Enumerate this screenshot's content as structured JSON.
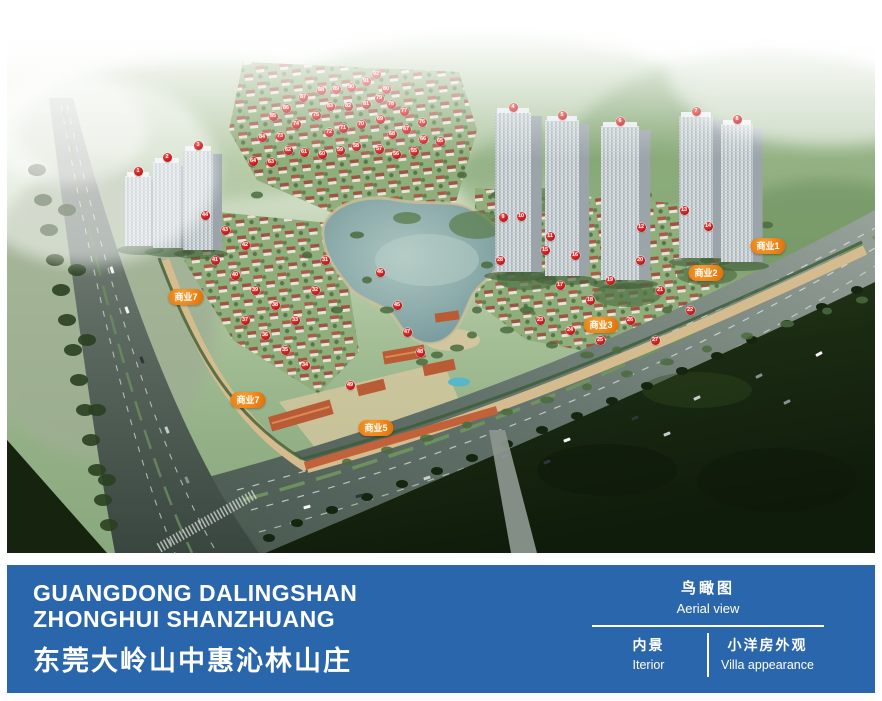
{
  "footer": {
    "bg": "#2a66ac",
    "title_en_line1": "GUANGDONG DALINGSHAN",
    "title_en_line2": "ZHONGHUI SHANZHUANG",
    "title_zh": "东莞大岭山中惠沁林山庄",
    "views": {
      "current": {
        "zh": "鸟瞰图",
        "en": "Aerial view"
      },
      "others": [
        {
          "zh": "内景",
          "en": "Iterior"
        },
        {
          "zh": "小洋房外观",
          "en": "Villa appearance"
        }
      ]
    }
  },
  "site_plan": {
    "marker_color": "#cf1d1d",
    "biz_label_color": "#ec8418",
    "biz_labels": [
      {
        "text": "商业1",
        "x": 761,
        "y": 236
      },
      {
        "text": "商业2",
        "x": 699,
        "y": 263
      },
      {
        "text": "商业3",
        "x": 594,
        "y": 315
      },
      {
        "text": "商业5",
        "x": 369,
        "y": 418
      },
      {
        "text": "商业7",
        "x": 179,
        "y": 287
      },
      {
        "text": "商业7",
        "x": 241,
        "y": 390
      }
    ],
    "markers": [
      {
        "n": 1,
        "x": 131,
        "y": 161
      },
      {
        "n": 2,
        "x": 160,
        "y": 147
      },
      {
        "n": 3,
        "x": 191,
        "y": 135
      },
      {
        "n": 4,
        "x": 506,
        "y": 97
      },
      {
        "n": 5,
        "x": 555,
        "y": 105
      },
      {
        "n": 6,
        "x": 613,
        "y": 111
      },
      {
        "n": 7,
        "x": 689,
        "y": 101
      },
      {
        "n": 8,
        "x": 730,
        "y": 109
      },
      {
        "n": 9,
        "x": 496,
        "y": 207
      },
      {
        "n": 10,
        "x": 514,
        "y": 206
      },
      {
        "n": 11,
        "x": 543,
        "y": 226
      },
      {
        "n": 12,
        "x": 634,
        "y": 217
      },
      {
        "n": 13,
        "x": 677,
        "y": 200
      },
      {
        "n": 14,
        "x": 701,
        "y": 216
      },
      {
        "n": 15,
        "x": 538,
        "y": 240
      },
      {
        "n": 16,
        "x": 568,
        "y": 245
      },
      {
        "n": 17,
        "x": 553,
        "y": 275
      },
      {
        "n": 18,
        "x": 583,
        "y": 290
      },
      {
        "n": 19,
        "x": 603,
        "y": 270
      },
      {
        "n": 20,
        "x": 633,
        "y": 250
      },
      {
        "n": 21,
        "x": 653,
        "y": 280
      },
      {
        "n": 22,
        "x": 683,
        "y": 300
      },
      {
        "n": 23,
        "x": 533,
        "y": 310
      },
      {
        "n": 24,
        "x": 563,
        "y": 320
      },
      {
        "n": 25,
        "x": 593,
        "y": 330
      },
      {
        "n": 26,
        "x": 623,
        "y": 310
      },
      {
        "n": 27,
        "x": 648,
        "y": 330
      },
      {
        "n": 28,
        "x": 493,
        "y": 250
      },
      {
        "n": 31,
        "x": 318,
        "y": 250
      },
      {
        "n": 32,
        "x": 308,
        "y": 280
      },
      {
        "n": 33,
        "x": 288,
        "y": 310
      },
      {
        "n": 34,
        "x": 298,
        "y": 355
      },
      {
        "n": 35,
        "x": 278,
        "y": 340
      },
      {
        "n": 36,
        "x": 258,
        "y": 325
      },
      {
        "n": 37,
        "x": 238,
        "y": 310
      },
      {
        "n": 38,
        "x": 268,
        "y": 295
      },
      {
        "n": 39,
        "x": 248,
        "y": 280
      },
      {
        "n": 40,
        "x": 228,
        "y": 265
      },
      {
        "n": 41,
        "x": 208,
        "y": 250
      },
      {
        "n": 42,
        "x": 238,
        "y": 235
      },
      {
        "n": 43,
        "x": 218,
        "y": 220
      },
      {
        "n": 44,
        "x": 198,
        "y": 205
      },
      {
        "n": 45,
        "x": 390,
        "y": 295
      },
      {
        "n": 46,
        "x": 373,
        "y": 262
      },
      {
        "n": 47,
        "x": 400,
        "y": 322
      },
      {
        "n": 48,
        "x": 413,
        "y": 342
      },
      {
        "n": 49,
        "x": 343,
        "y": 375
      },
      {
        "n": 55,
        "x": 407,
        "y": 141
      },
      {
        "n": 56,
        "x": 389,
        "y": 144
      },
      {
        "n": 57,
        "x": 372,
        "y": 139
      },
      {
        "n": 58,
        "x": 349,
        "y": 136
      },
      {
        "n": 59,
        "x": 333,
        "y": 140
      },
      {
        "n": 60,
        "x": 315,
        "y": 144
      },
      {
        "n": 61,
        "x": 297,
        "y": 142
      },
      {
        "n": 62,
        "x": 281,
        "y": 140
      },
      {
        "n": 63,
        "x": 264,
        "y": 152
      },
      {
        "n": 64,
        "x": 246,
        "y": 151
      },
      {
        "n": 65,
        "x": 433,
        "y": 131
      },
      {
        "n": 66,
        "x": 416,
        "y": 129
      },
      {
        "n": 67,
        "x": 399,
        "y": 119
      },
      {
        "n": 68,
        "x": 385,
        "y": 124
      },
      {
        "n": 69,
        "x": 373,
        "y": 109
      },
      {
        "n": 70,
        "x": 354,
        "y": 114
      },
      {
        "n": 71,
        "x": 336,
        "y": 118
      },
      {
        "n": 72,
        "x": 322,
        "y": 122
      },
      {
        "n": 73,
        "x": 273,
        "y": 126
      },
      {
        "n": 74,
        "x": 289,
        "y": 114
      },
      {
        "n": 75,
        "x": 309,
        "y": 105
      },
      {
        "n": 76,
        "x": 415,
        "y": 112
      },
      {
        "n": 77,
        "x": 397,
        "y": 101
      },
      {
        "n": 78,
        "x": 384,
        "y": 94
      },
      {
        "n": 79,
        "x": 372,
        "y": 88
      },
      {
        "n": 80,
        "x": 379,
        "y": 79
      },
      {
        "n": 81,
        "x": 359,
        "y": 94
      },
      {
        "n": 82,
        "x": 341,
        "y": 96
      },
      {
        "n": 83,
        "x": 323,
        "y": 96
      },
      {
        "n": 84,
        "x": 255,
        "y": 127
      },
      {
        "n": 85,
        "x": 266,
        "y": 106
      },
      {
        "n": 86,
        "x": 279,
        "y": 98
      },
      {
        "n": 87,
        "x": 296,
        "y": 87
      },
      {
        "n": 88,
        "x": 314,
        "y": 80
      },
      {
        "n": 89,
        "x": 329,
        "y": 79
      },
      {
        "n": 90,
        "x": 344,
        "y": 77
      },
      {
        "n": 91,
        "x": 359,
        "y": 71
      },
      {
        "n": 92,
        "x": 369,
        "y": 64
      }
    ]
  }
}
